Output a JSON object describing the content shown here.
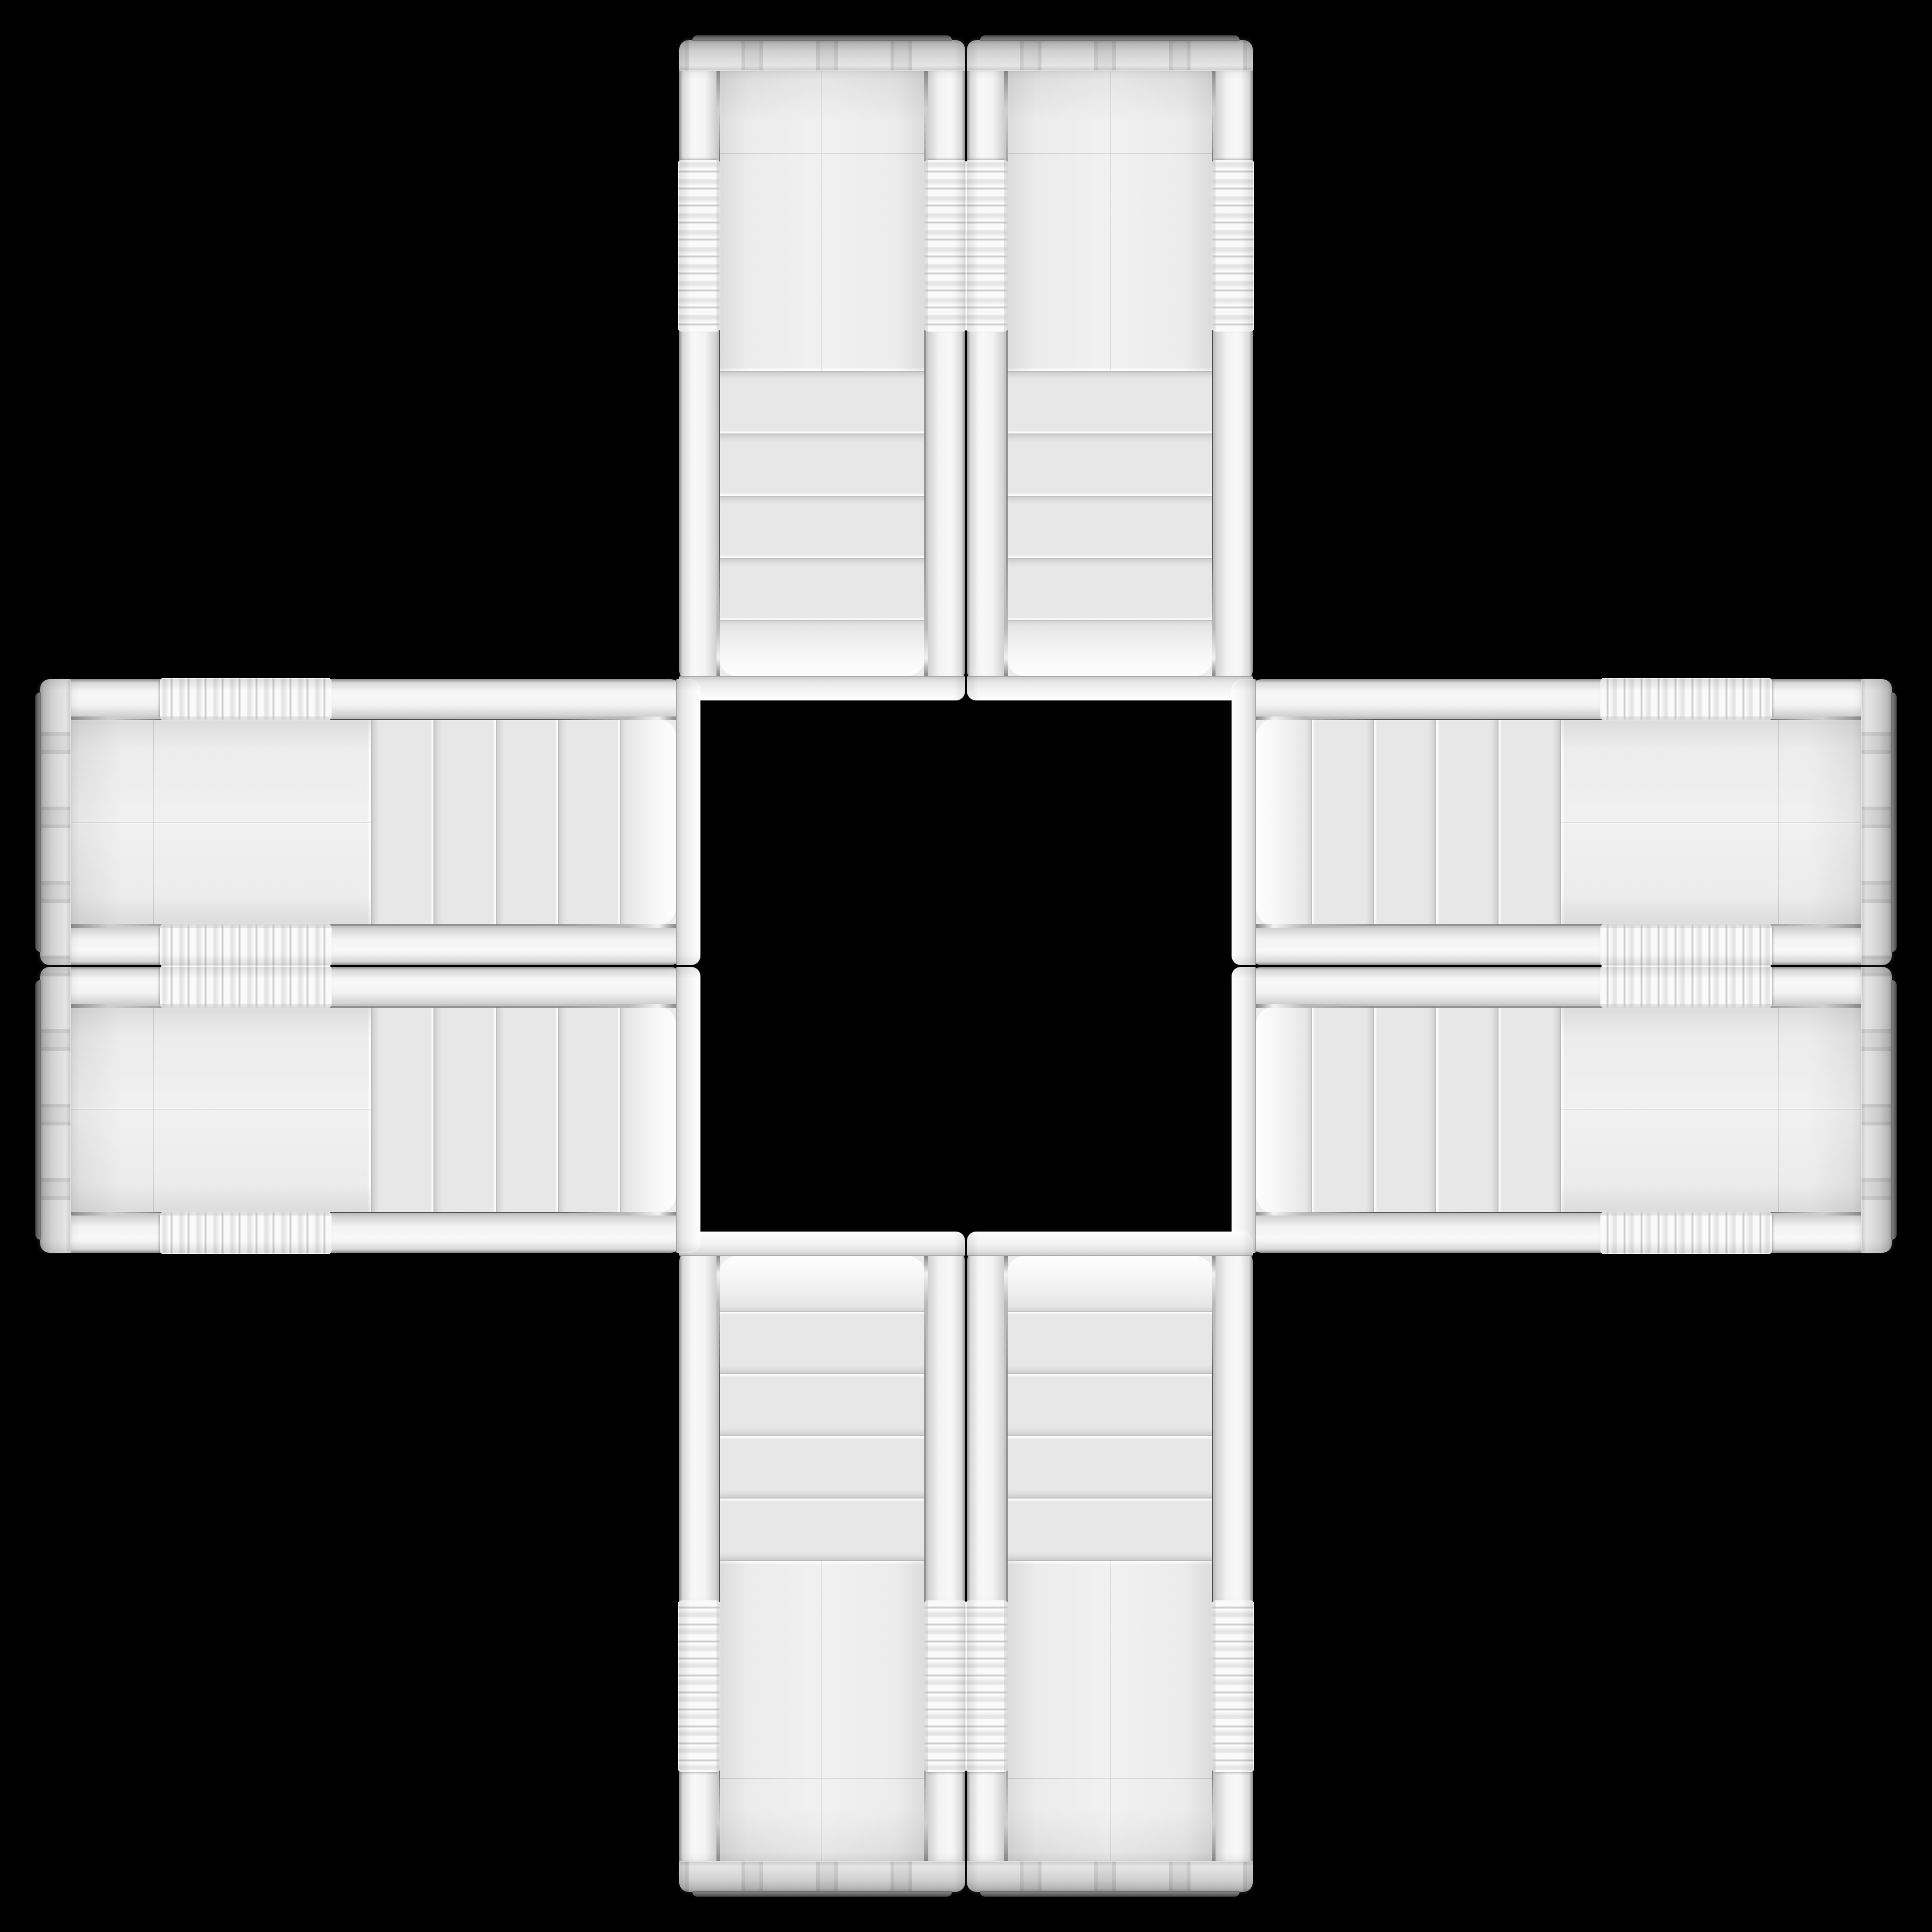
{
  "scene": {
    "description": "Eight identical white Cooler Master computer case front panels arranged in a cross pattern on a black background",
    "background_color": "#000000",
    "panel_count": 8
  },
  "brand_badge": {
    "line1": "COOLER",
    "line2": "MASTER",
    "badge_color": "#383838",
    "text_color": "#f7f7f7",
    "ring_color": "#d9d9d9"
  },
  "colors": {
    "panel_body": "#f0f0f0",
    "mesh_base": "#ededed",
    "mesh_holes": "#bdbdbd",
    "chrome_trim": "#9a9a9a",
    "cap": "#f3f3f3"
  },
  "panels": [
    {
      "position": "top-left",
      "orientation": "rotated-180"
    },
    {
      "position": "top-right",
      "orientation": "flipped-vertical"
    },
    {
      "position": "bottom-left",
      "orientation": "flipped-horizontal"
    },
    {
      "position": "bottom-right",
      "orientation": "upright"
    },
    {
      "position": "left-top",
      "orientation": "rotated-90-cw"
    },
    {
      "position": "left-bottom",
      "orientation": "rotated-90-ccw-mirrored"
    },
    {
      "position": "right-top",
      "orientation": "rotated-90-ccw-flipped"
    },
    {
      "position": "right-bottom",
      "orientation": "rotated-90-ccw"
    }
  ]
}
